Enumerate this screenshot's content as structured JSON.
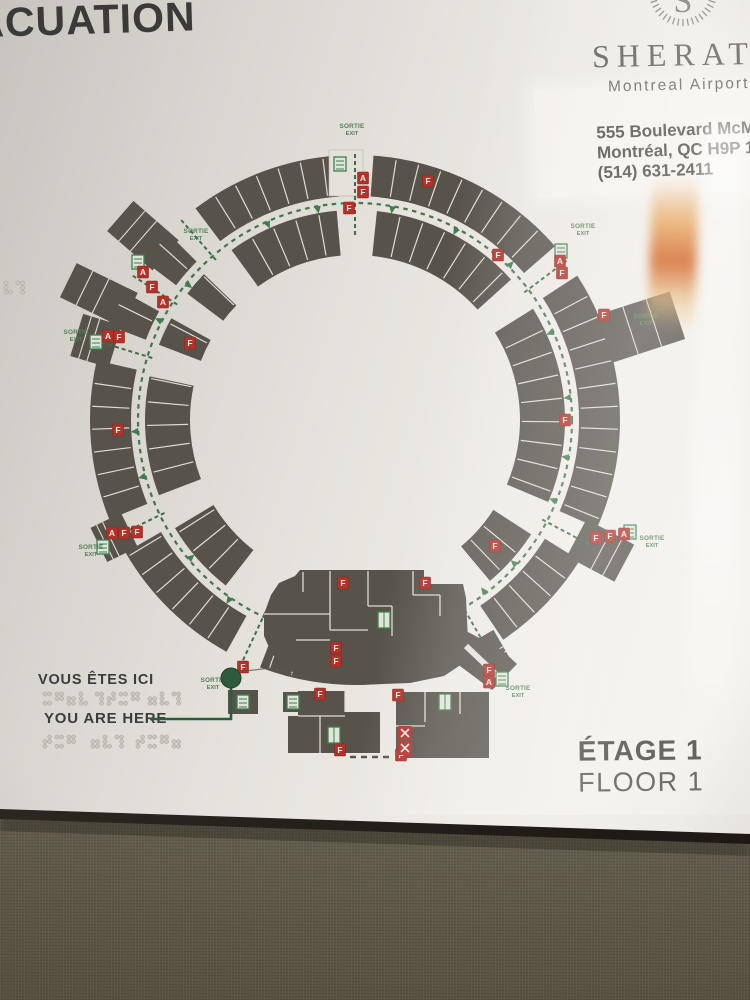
{
  "sign": {
    "title": "ÉVACUATION",
    "brand": {
      "monogram": "S",
      "name": "SHERATON",
      "subtitle": "Montreal Airport Hotel",
      "address_line1": "555 Boulevard McMillan",
      "address_line2": "Montréal, QC H9P 1B7",
      "phone": "(514) 631-2411"
    },
    "you_are_here": {
      "fr": "VOUS ÊTES ICI",
      "en": "YOU ARE HERE"
    },
    "floor": {
      "fr": "ÉTAGE 1",
      "en": "FLOOR 1"
    }
  },
  "map": {
    "exit_label": {
      "fr": "SORTIE",
      "en": "EXIT"
    },
    "colors": {
      "room": "#57534b",
      "divider": "#dfdcd4",
      "path": "#3e6f48",
      "exit_text": "#54805a",
      "marker": "#b23129",
      "marker_text": "#f4e8e2",
      "icon": "#3f7d4f",
      "icon_fill": "#dfe5da",
      "you_dot": "#2e5b3e",
      "bg": "#e4e1db"
    },
    "center": {
      "x": 355,
      "y": 420
    },
    "rings": {
      "outer": {
        "r0": 224,
        "r1": 265,
        "step": 5,
        "segments": [
          [
            4,
            49
          ],
          [
            57,
            114
          ],
          [
            122,
            146
          ],
          [
            154,
            201
          ],
          [
            209,
            240
          ],
          [
            248,
            283
          ],
          [
            291,
            299
          ],
          [
            307,
            315
          ],
          [
            323,
            356
          ]
        ]
      },
      "inner": {
        "r0": 165,
        "r1": 210,
        "step": 6.5,
        "segments": [
          [
            6,
            48
          ],
          [
            58,
            113
          ],
          [
            123,
            140
          ],
          [
            218,
            239
          ],
          [
            249,
            282
          ],
          [
            291,
            299
          ],
          [
            307,
            314
          ],
          [
            324,
            355
          ]
        ]
      }
    },
    "corridor_radius": 217,
    "exit_passages": [
      0,
      53,
      118,
      150,
      205,
      244,
      287,
      303,
      319
    ],
    "wings": [
      {
        "a": 311,
        "len": 46,
        "w": 40
      },
      {
        "a": 296,
        "len": 54,
        "w": 38
      },
      {
        "a": 287,
        "len": 26,
        "w": 44
      },
      {
        "a": 244,
        "len": 20,
        "w": 38
      },
      {
        "a": 72,
        "len": 74,
        "w": 50
      },
      {
        "a": 118,
        "len": 40,
        "w": 42
      },
      {
        "a": 150,
        "len": 16,
        "w": 30
      }
    ],
    "arrows": [
      {
        "a": 10,
        "d": 1
      },
      {
        "a": 28,
        "d": 1
      },
      {
        "a": 45,
        "d": -1
      },
      {
        "a": 66,
        "d": 1
      },
      {
        "a": 84,
        "d": 1
      },
      {
        "a": 100,
        "d": 1
      },
      {
        "a": 112,
        "d": 1
      },
      {
        "a": 132,
        "d": 1
      },
      {
        "a": 143,
        "d": 1
      },
      {
        "a": 165,
        "d": -1
      },
      {
        "a": 186,
        "d": 1
      },
      {
        "a": 215,
        "d": -1
      },
      {
        "a": 230,
        "d": 1
      },
      {
        "a": 255,
        "d": -1
      },
      {
        "a": 267,
        "d": -1
      },
      {
        "a": 297,
        "d": -1
      },
      {
        "a": 309,
        "d": 1
      },
      {
        "a": 336,
        "d": 1
      },
      {
        "a": 350,
        "d": 1
      }
    ],
    "exit_labels": [
      {
        "x": 352,
        "y": 128
      },
      {
        "x": 196,
        "y": 233
      },
      {
        "x": 76,
        "y": 334
      },
      {
        "x": 91,
        "y": 549
      },
      {
        "x": 213,
        "y": 682
      },
      {
        "x": 518,
        "y": 690
      },
      {
        "x": 652,
        "y": 540
      },
      {
        "x": 583,
        "y": 228
      },
      {
        "x": 646,
        "y": 318
      }
    ],
    "markers": [
      {
        "x": 363,
        "y": 178,
        "l": "A"
      },
      {
        "x": 363,
        "y": 192,
        "l": "F"
      },
      {
        "x": 349,
        "y": 208,
        "l": "F"
      },
      {
        "x": 428,
        "y": 181,
        "l": "F"
      },
      {
        "x": 143,
        "y": 272,
        "l": "A"
      },
      {
        "x": 152,
        "y": 287,
        "l": "F"
      },
      {
        "x": 163,
        "y": 302,
        "l": "A"
      },
      {
        "x": 108,
        "y": 336,
        "l": "A"
      },
      {
        "x": 119,
        "y": 337,
        "l": "F"
      },
      {
        "x": 190,
        "y": 343,
        "l": "F"
      },
      {
        "x": 118,
        "y": 430,
        "l": "F"
      },
      {
        "x": 112,
        "y": 533,
        "l": "A"
      },
      {
        "x": 124,
        "y": 533,
        "l": "F"
      },
      {
        "x": 137,
        "y": 532,
        "l": "F"
      },
      {
        "x": 243,
        "y": 667,
        "l": "F"
      },
      {
        "x": 343,
        "y": 583,
        "l": "F"
      },
      {
        "x": 425,
        "y": 583,
        "l": "F"
      },
      {
        "x": 336,
        "y": 648,
        "l": "F"
      },
      {
        "x": 336,
        "y": 661,
        "l": "F"
      },
      {
        "x": 320,
        "y": 694,
        "l": "F"
      },
      {
        "x": 398,
        "y": 695,
        "l": "F"
      },
      {
        "x": 489,
        "y": 670,
        "l": "F"
      },
      {
        "x": 489,
        "y": 682,
        "l": "A"
      },
      {
        "x": 340,
        "y": 750,
        "l": "F"
      },
      {
        "x": 401,
        "y": 755,
        "l": "F"
      },
      {
        "x": 596,
        "y": 538,
        "l": "F"
      },
      {
        "x": 610,
        "y": 536,
        "l": "F"
      },
      {
        "x": 624,
        "y": 534,
        "l": "A"
      },
      {
        "x": 495,
        "y": 546,
        "l": "F"
      },
      {
        "x": 565,
        "y": 420,
        "l": "F"
      },
      {
        "x": 498,
        "y": 255,
        "l": "F"
      },
      {
        "x": 560,
        "y": 261,
        "l": "A"
      },
      {
        "x": 562,
        "y": 273,
        "l": "F"
      },
      {
        "x": 604,
        "y": 315,
        "l": "F"
      }
    ],
    "stairs": [
      [
        340,
        164
      ],
      [
        138,
        262
      ],
      [
        561,
        251
      ],
      [
        630,
        532
      ],
      [
        502,
        679
      ],
      [
        96,
        342
      ],
      [
        103,
        547
      ],
      [
        243,
        702
      ],
      [
        293,
        702
      ]
    ],
    "lifts": [
      [
        384,
        620
      ],
      [
        334,
        735
      ],
      [
        445,
        702
      ]
    ],
    "x_boxes": [
      [
        405,
        733
      ],
      [
        405,
        748
      ]
    ],
    "top_exit_box": {
      "x": 329,
      "y": 150,
      "w": 34,
      "h": 46
    },
    "lobby": {
      "outline": "M295,576 L300,570 L424,570 L424,584 L463,584 L466,598 L468,640 L462,664 L444,676 L410,683 L358,685 L315,681 L288,670 L272,654 L264,636 L264,614 L271,595 L279,583 Z",
      "lines": [
        [
          303,
          572,
          303,
          592
        ],
        [
          330,
          571,
          330,
          630
        ],
        [
          368,
          571,
          368,
          606
        ],
        [
          368,
          606,
          392,
          606
        ],
        [
          392,
          606,
          392,
          636
        ],
        [
          413,
          571,
          413,
          595
        ],
        [
          413,
          595,
          440,
          595
        ],
        [
          440,
          595,
          440,
          616
        ],
        [
          264,
          614,
          330,
          614
        ],
        [
          296,
          640,
          330,
          640
        ],
        [
          330,
          630,
          368,
          630
        ]
      ]
    },
    "buildings": [
      {
        "outline": "M298,691 L345,691 L345,712 L380,712 L380,753 L288,753 L288,716 L298,716 Z",
        "lines": [
          [
            298,
            716,
            345,
            716
          ],
          [
            320,
            716,
            320,
            753
          ],
          [
            345,
            691,
            345,
            712
          ]
        ]
      },
      {
        "outline": "M396,692 L489,692 L489,758 L396,758 Z",
        "lines": [
          [
            425,
            692,
            425,
            722
          ],
          [
            396,
            726,
            425,
            726
          ],
          [
            460,
            692,
            460,
            714
          ]
        ]
      },
      {
        "outline": "M468,632 L502,650 L517,664 L492,690 L452,660 Z",
        "lines": []
      },
      {
        "outline": "M228,690 L258,690 L258,714 L228,714 Z",
        "lines": []
      },
      {
        "outline": "M283,692 L307,692 L307,712 L283,712 Z",
        "lines": []
      }
    ],
    "connector_white": [
      466,
      646,
      506,
      684
    ],
    "gap_dash": [
      350,
      757,
      394,
      757
    ],
    "you_line": [
      [
        150,
        719
      ],
      [
        231,
        719
      ],
      [
        231,
        688
      ]
    ],
    "you_dot": {
      "x": 231,
      "y": 678,
      "r": 10
    },
    "wall_trace": [
      [
        246,
        671
      ],
      [
        270,
        668
      ],
      [
        300,
        676
      ],
      [
        330,
        683
      ]
    ],
    "braille_rows": [
      {
        "y": 694,
        "words": [
          {
            "x": 45,
            "n": 4
          },
          {
            "x": 97,
            "n": 4
          },
          {
            "x": 150,
            "n": 3
          }
        ]
      },
      {
        "y": 737,
        "words": [
          {
            "x": 45,
            "n": 3
          },
          {
            "x": 93,
            "n": 3
          },
          {
            "x": 138,
            "n": 4
          }
        ]
      },
      {
        "y": 283,
        "words": [
          {
            "x": 6,
            "n": 2
          }
        ]
      }
    ],
    "wreath": {
      "cx": 683,
      "cy": -8,
      "r0": 27,
      "r1": 34
    }
  }
}
